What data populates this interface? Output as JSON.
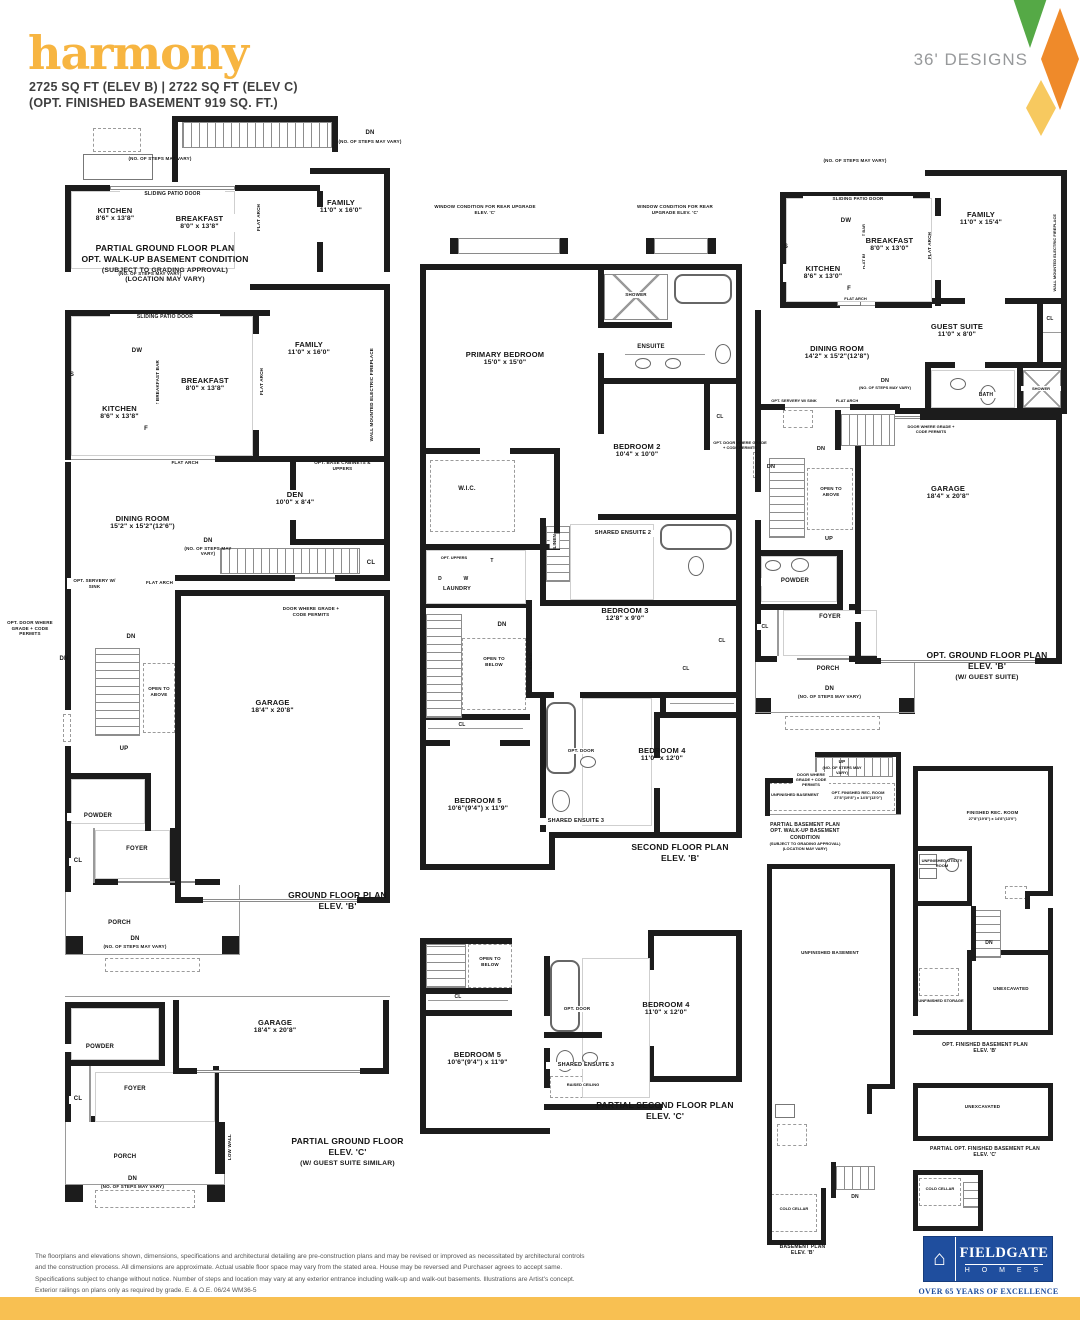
{
  "header": {
    "title": "harmony",
    "specs": "2725 SQ FT (ELEV B)  |  2722 SQ FT (ELEV C)",
    "specs2": "(OPT. FINISHED BASEMENT 919 SQ. FT.)",
    "designs": "36' DESIGNS"
  },
  "colors": {
    "accent_yellow": "#F7B541",
    "diamond_green": "#55A946",
    "diamond_orange": "#EF8A2A",
    "diamond_yellow": "#F7C95F",
    "logo_blue": "#1F4E9E",
    "footer_bar": "#F8C052"
  },
  "common": {
    "dn": "DN",
    "up": "UP",
    "cl": "CL",
    "dw": "DW",
    "s": "S",
    "f": "F",
    "d": "D",
    "w": "W",
    "t": "T",
    "steps": "(NO. OF STEPS MAY VARY)",
    "sliding": "SLIDING PATIO DOOR",
    "flat_arch": "FLAT ARCH",
    "breakfast_bar": "FLAT BREAKFAST BAR",
    "fireplace": "WALL MOUNTED ELECTRIC FIREPLACE",
    "door_grade": "DOOR WHERE GRADE + CODE PERMITS",
    "opt_door_grade": "OPT. DOOR WHERE GRADE + CODE PERMITS",
    "servery": "OPT. SERVERY W/ SINK",
    "open_above": "OPEN TO ABOVE",
    "open_below": "OPEN TO BELOW",
    "railing": "RAILING",
    "linen": "LINEN",
    "laundry": "LAUNDRY",
    "powder": "POWDER",
    "foyer": "FOYER",
    "porch": "PORCH",
    "shower": "SHOWER",
    "ensuite": "ENSUITE",
    "bath": "BATH",
    "opt_door": "OPT. DOOR",
    "opt_uppers": "OPT. UPPERS",
    "opt_base": "OPT. BASE CABINETS & UPPERS",
    "low_wall": "LOW WALL",
    "raised_ceiling": "RAISED CEILING",
    "win_cond": "WINDOW CONDITION FOR REAR UPGRADE ELEV. 'C'",
    "unfinished_basement": "UNFINISHED BASEMENT",
    "unfinished_storage": "UNFINISHED STORAGE",
    "unexcavated": "UNEXCAVATED",
    "cold_cellar": "COLD CELLAR",
    "shared2": "SHARED ENSUITE 2",
    "shared3": "SHARED ENSUITE 3",
    "wic": "W.I.C."
  },
  "rooms": {
    "kitchen_b": {
      "name": "KITCHEN",
      "dim": "8'6\" x 13'8\""
    },
    "breakfast_b": {
      "name": "BREAKFAST",
      "dim": "8'0\" x 13'8\""
    },
    "family_b": {
      "name": "FAMILY",
      "dim": "11'0\" x 16'0\""
    },
    "den": {
      "name": "DEN",
      "dim": "10'0\" x 8'4\""
    },
    "dining_b": {
      "name": "DINING ROOM",
      "dim": "15'2\" x 15'2\"(12'6\")"
    },
    "garage": {
      "name": "GARAGE",
      "dim": "18'4\" x 20'8\""
    },
    "primary": {
      "name": "PRIMARY BEDROOM",
      "dim": "15'0\" x 15'0\""
    },
    "bed2": {
      "name": "BEDROOM 2",
      "dim": "10'4\" x 10'0\""
    },
    "bed3": {
      "name": "BEDROOM 3",
      "dim": "12'8\" x 9'0\""
    },
    "bed4": {
      "name": "BEDROOM 4",
      "dim": "11'0\" x 12'0\""
    },
    "bed5": {
      "name": "BEDROOM 5",
      "dim": "10'6\"(9'4\") x 11'9\""
    },
    "kitchen_f": {
      "name": "KITCHEN",
      "dim": "8'6\" x 13'0\""
    },
    "breakfast_f": {
      "name": "BREAKFAST",
      "dim": "8'0\" x 13'0\""
    },
    "family_f": {
      "name": "FAMILY",
      "dim": "11'0\" x 15'4\""
    },
    "dining_f": {
      "name": "DINING ROOM",
      "dim": "14'2\" x 15'2\"(12'8\")"
    },
    "guest": {
      "name": "GUEST SUITE",
      "dim": "11'0\" x 8'0\""
    },
    "rec_opt": {
      "name": "OPT. FINISHED REC. ROOM",
      "dim": "27'8\"(19'8\") x 14'8\"(13'0\")"
    },
    "rec": {
      "name": "FINISHED REC. ROOM",
      "dim": "27'8\"(19'8\") x 14'8\"(13'0\")"
    },
    "utility": {
      "name": "UNFINISHED UTILITY ROOM"
    }
  },
  "captions": {
    "pA": [
      "PARTIAL GROUND FLOOR PLAN",
      "OPT. WALK-UP BASEMENT CONDITION",
      "(SUBJECT TO GRADING APPROVAL)",
      "(LOCATION MAY VARY)"
    ],
    "pB": [
      "GROUND FLOOR PLAN",
      "ELEV. 'B'"
    ],
    "pC": [
      "PARTIAL GROUND FLOOR",
      "ELEV. 'C'",
      "(W/ GUEST SUITE SIMILAR)"
    ],
    "pD": [
      "SECOND FLOOR PLAN",
      "ELEV. 'B'"
    ],
    "pE": [
      "PARTIAL SECOND FLOOR PLAN",
      "ELEV. 'C'"
    ],
    "pF": [
      "OPT. GROUND FLOOR PLAN",
      "ELEV. 'B'",
      "(W/ GUEST SUITE)"
    ],
    "g1": [
      "PARTIAL BASEMENT PLAN",
      "OPT. WALK-UP BASEMENT CONDITION",
      "(SUBJECT TO GRADING APPROVAL)",
      "(LOCATION MAY VARY)"
    ],
    "g2": [
      "BASEMENT PLAN",
      "ELEV. 'B'"
    ],
    "g3": [
      "OPT. FINISHED BASEMENT PLAN",
      "ELEV. 'B'"
    ],
    "g4": [
      "PARTIAL OPT. FINISHED BASEMENT PLAN",
      "ELEV. 'C'"
    ]
  },
  "footer": {
    "disclaimer": [
      "The floorplans and elevations shown, dimensions, specifications and architectural detailing are pre-construction plans and may be revised or improved as necessitated by architectural controls",
      "and the construction process. All dimensions are approximate. Actual usable floor space may vary from the stated area. House may be reversed and Purchaser agrees to accept same.",
      "Specifications subject to change without notice. Number of steps and location may vary at any exterior entrance including walk-up and walk-out basements. Illustrations are Artist's concept.",
      "Exterior railings on plans only as required by grade. E. & O.E. 06/24 WM36-5"
    ],
    "logo_name": "FIELDGATE",
    "logo_homes": "H O M E S",
    "logo_tagline": "OVER 65 YEARS OF EXCELLENCE"
  }
}
